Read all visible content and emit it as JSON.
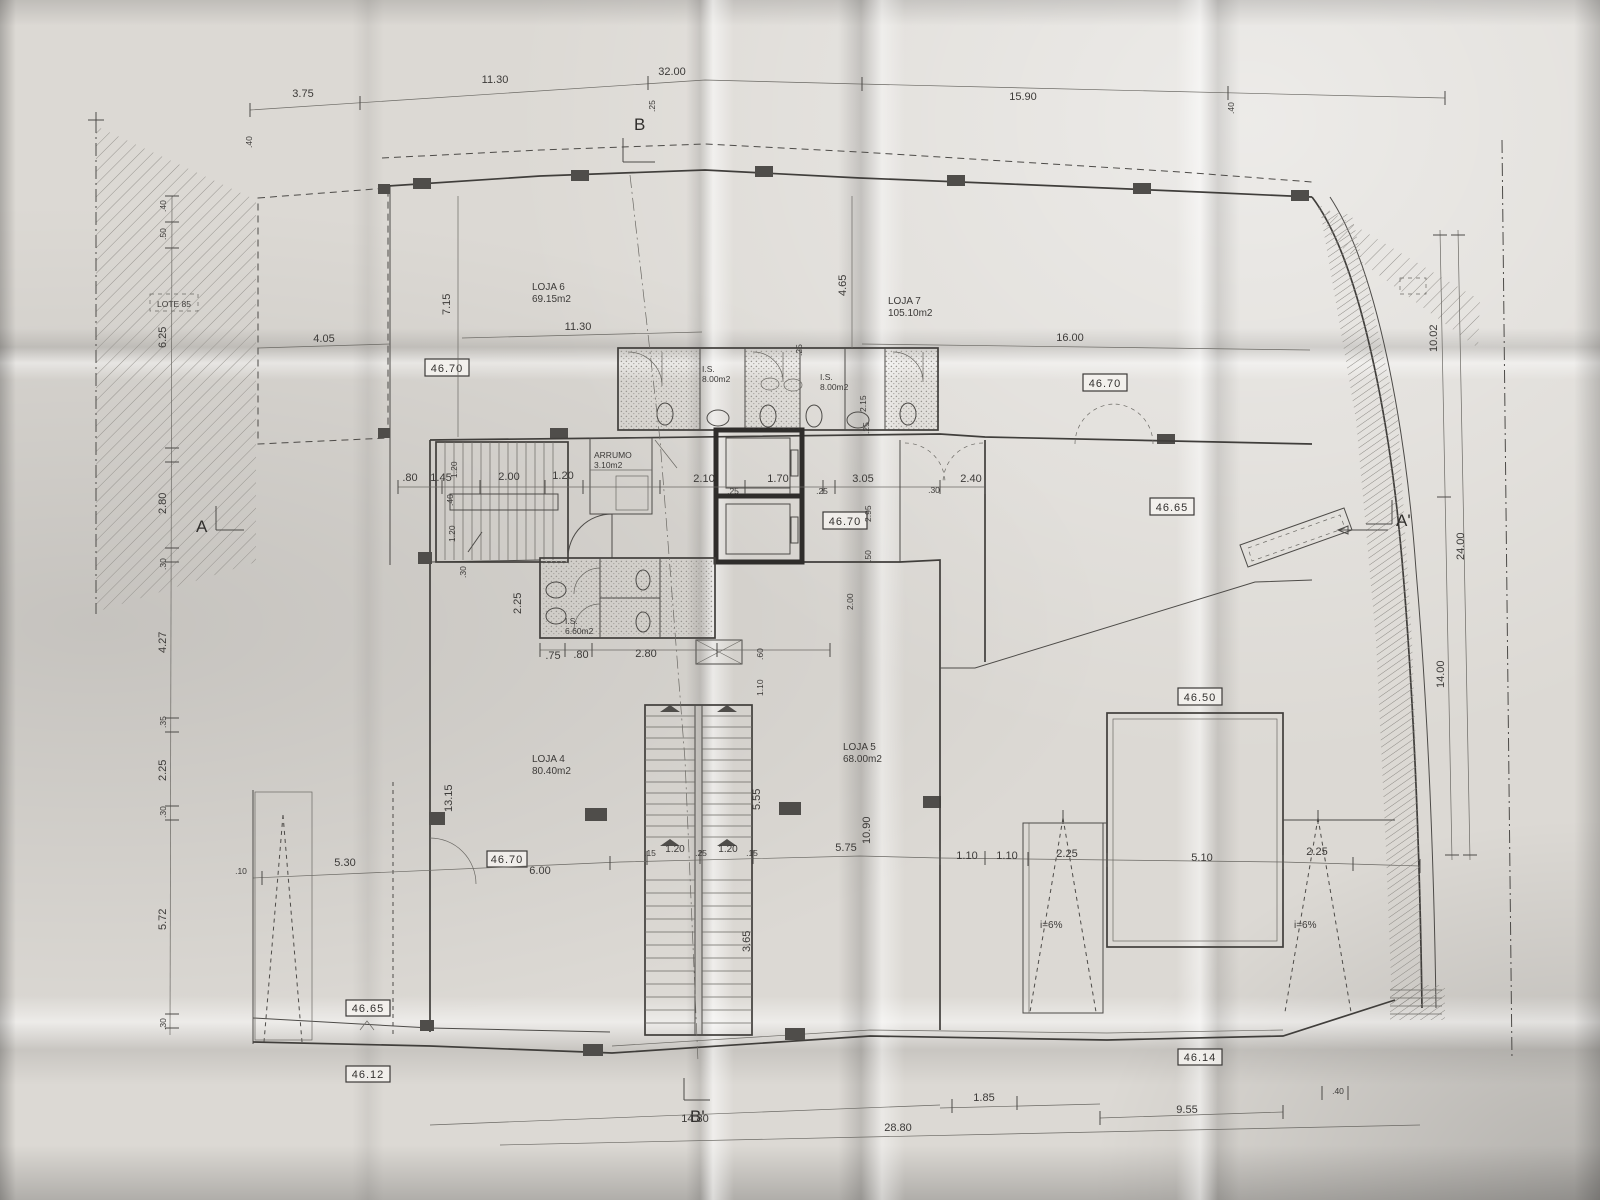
{
  "markers": {
    "b": "B",
    "b_prime": "B'",
    "a": "A",
    "a_prime": "A'"
  },
  "site": {
    "lote": "LOTE 85"
  },
  "rooms": {
    "loja6": {
      "name": "LOJA 6",
      "area": "69.15m2"
    },
    "loja7": {
      "name": "LOJA 7",
      "area": "105.10m2"
    },
    "loja4": {
      "name": "LOJA 4",
      "area": "80.40m2"
    },
    "loja5": {
      "name": "LOJA 5",
      "area": "68.00m2"
    },
    "is1": {
      "name": "I.S.",
      "area": "8.00m2"
    },
    "is2": {
      "name": "I.S.",
      "area": "8.00m2"
    },
    "is3": {
      "name": "I.S.",
      "area": "6.60m2"
    },
    "arrumo": {
      "name": "ARRUMO",
      "area": "3.10m2"
    }
  },
  "levels": {
    "a": "46.70",
    "b": "46.70",
    "c": "46.65",
    "d": "46.70",
    "e": "46.50",
    "f": "46.70",
    "g": "46.65",
    "h": "46.12",
    "i": "46.14"
  },
  "slopes": {
    "left": "i=6%",
    "right": "i=6%"
  },
  "dims_top": [
    ".40",
    "3.75",
    "11.30",
    "32.00",
    ".25",
    "15.90",
    ".40"
  ],
  "dims_left": [
    ".40",
    ".50",
    "6.25",
    "2.80",
    ".30",
    "4.27",
    ".35",
    "2.25",
    ".30",
    "5.72",
    ".30"
  ],
  "dims_right": [
    "10.02",
    "14.00",
    "24.00"
  ],
  "dims_upper": [
    "4.05",
    "7.15",
    "11.30",
    ".25",
    "4.65",
    "16.00",
    "2.15",
    ".25"
  ],
  "dims_core": [
    ".80",
    "1.45",
    "1.20",
    ".40",
    "1.20",
    "2.00",
    "1.20",
    "2.10",
    ".25",
    "1.70",
    ".25",
    "3.05",
    ".30",
    "2.40",
    "2.95",
    ".50",
    "2.00"
  ],
  "dims_ws": [
    ".30",
    "2.25",
    ".75",
    ".80",
    "2.80",
    ".60",
    "1.10"
  ],
  "dims_stair": [
    "5.55",
    "13.15",
    "3.65",
    ".15",
    "1.20",
    ".25",
    "1.20",
    ".15",
    "10.90"
  ],
  "dims_lower": [
    ".10",
    "5.30",
    "6.00",
    "5.75",
    "1.10",
    "1.10",
    "2.25",
    "5.10",
    "2.25"
  ],
  "dims_bottom": [
    "14.80",
    "28.80",
    "1.85",
    "9.55",
    ".40"
  ]
}
